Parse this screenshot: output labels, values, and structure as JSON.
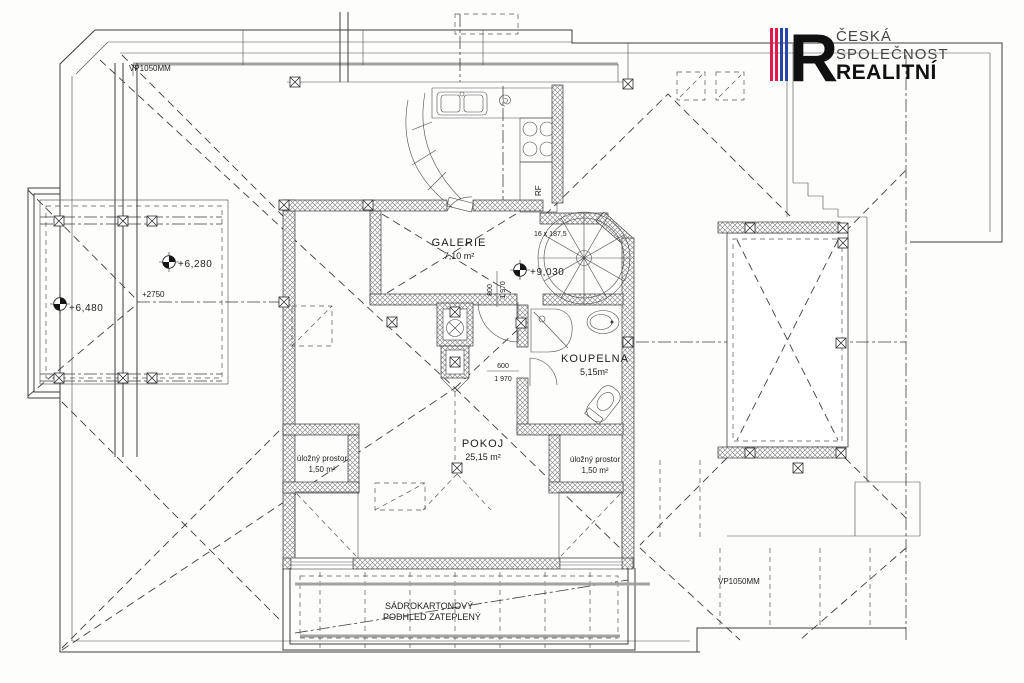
{
  "logo": {
    "line1": "ČESKÁ",
    "line2": "SPOLEČNOST",
    "line3": "REALITNÍ",
    "monogram": "R",
    "stripe_red": "#e4174b",
    "stripe_blue": "#2744a9"
  },
  "rooms": {
    "galerie": {
      "name": "GALERIE",
      "area": "7,10 m²"
    },
    "koupelna": {
      "name": "KOUPELNA",
      "area": "5,15m²"
    },
    "pokoj": {
      "name": "POKOJ",
      "area": "25,15 m²"
    },
    "storage_left": {
      "name": "úložný prostor",
      "area": "1,50 m²"
    },
    "storage_right": {
      "name": "úložný prostor",
      "area": "1,50 m²"
    }
  },
  "levels": {
    "left_outer": "+6,480",
    "left_inner": "+6,280",
    "ridge_note": "+2750",
    "gallery": "+9,030"
  },
  "dimensions": {
    "door_gallery_w": "800",
    "door_gallery_h": "1 970",
    "door_bath_w": "600",
    "door_bath_h": "1 970",
    "stair_note": "16 x 187,5"
  },
  "notes": {
    "vp_top_left": "VP1050MM",
    "vp_bottom_right": "VP1050MM",
    "ceiling_line1": "SÁDROKARTONOVÝ",
    "ceiling_line2": "PODHLED ZATEPLENÝ",
    "fridge": "RF"
  }
}
